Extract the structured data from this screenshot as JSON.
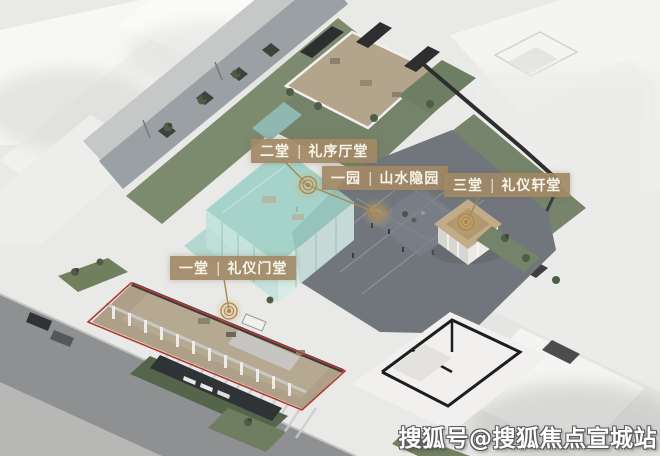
{
  "image_type": "architectural-axonometric-site-rendering",
  "labels": [
    {
      "id": "hall-2",
      "num": "二堂",
      "divider": "|",
      "name": "礼序厅堂"
    },
    {
      "id": "garden-1",
      "num": "一园",
      "divider": "|",
      "name": "山水隐园"
    },
    {
      "id": "hall-3",
      "num": "三堂",
      "divider": "|",
      "name": "礼仪轩堂"
    },
    {
      "id": "hall-1",
      "num": "一堂",
      "divider": "|",
      "name": "礼仪门堂"
    }
  ],
  "watermark": "搜狐号@搜狐焦点宣城站",
  "palette": {
    "label_plate": "#a18966",
    "label_text": "#f8f4ea",
    "marker_bronze": "#a8874f",
    "boundary_red": "#b23a31",
    "courtyard_gray": "#71767d",
    "glass_teal": "#9bcfc6",
    "lawn_green": "#75836a",
    "road_gray": "#8f9092",
    "context_white": "#f4f4f2",
    "watermark_text": "#ffffff"
  }
}
